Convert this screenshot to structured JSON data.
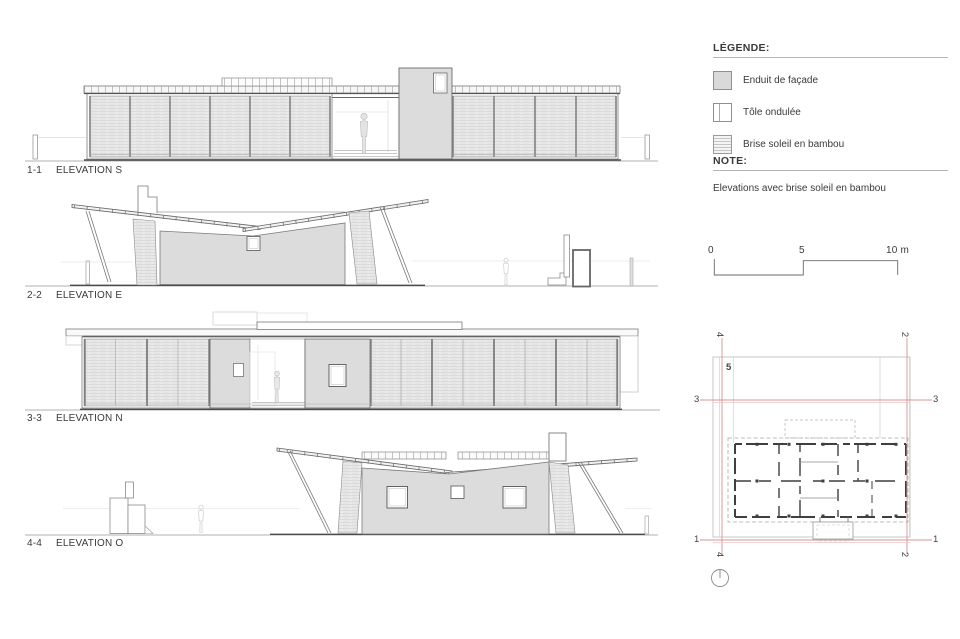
{
  "title": "Elevations drawing sheet",
  "colors": {
    "stucco_fill": "#dcdcdc",
    "line": "#666666",
    "light_line": "#bbbbbb",
    "section_line_red": "#d59494",
    "text": "#3a3a3a"
  },
  "elevations": [
    {
      "id": "1-1",
      "label": "ELEVATION S"
    },
    {
      "id": "2-2",
      "label": "ELEVATION E"
    },
    {
      "id": "3-3",
      "label": "ELEVATION N"
    },
    {
      "id": "4-4",
      "label": "ELEVATION O"
    }
  ],
  "legend": {
    "title": "LÉGENDE:",
    "items": [
      {
        "swatch": "stucco",
        "label": "Enduit de façade"
      },
      {
        "swatch": "corrugated",
        "label": "Tôle ondulée"
      },
      {
        "swatch": "bamboo",
        "label": "Brise soleil en bambou"
      }
    ]
  },
  "note": {
    "title": "NOTE:",
    "text": "Elevations avec brise soleil en bambou"
  },
  "scale_bar": {
    "tick_0": "0",
    "tick_5": "5",
    "tick_10": "10 m"
  },
  "plan": {
    "marks": {
      "top_left": "4",
      "top_right": "2",
      "bottom_left": "4",
      "bottom_right": "2",
      "upper_row_left": "3",
      "upper_row_right": "3",
      "lower_row_left": "1",
      "lower_row_right": "1",
      "interior": "5"
    }
  }
}
